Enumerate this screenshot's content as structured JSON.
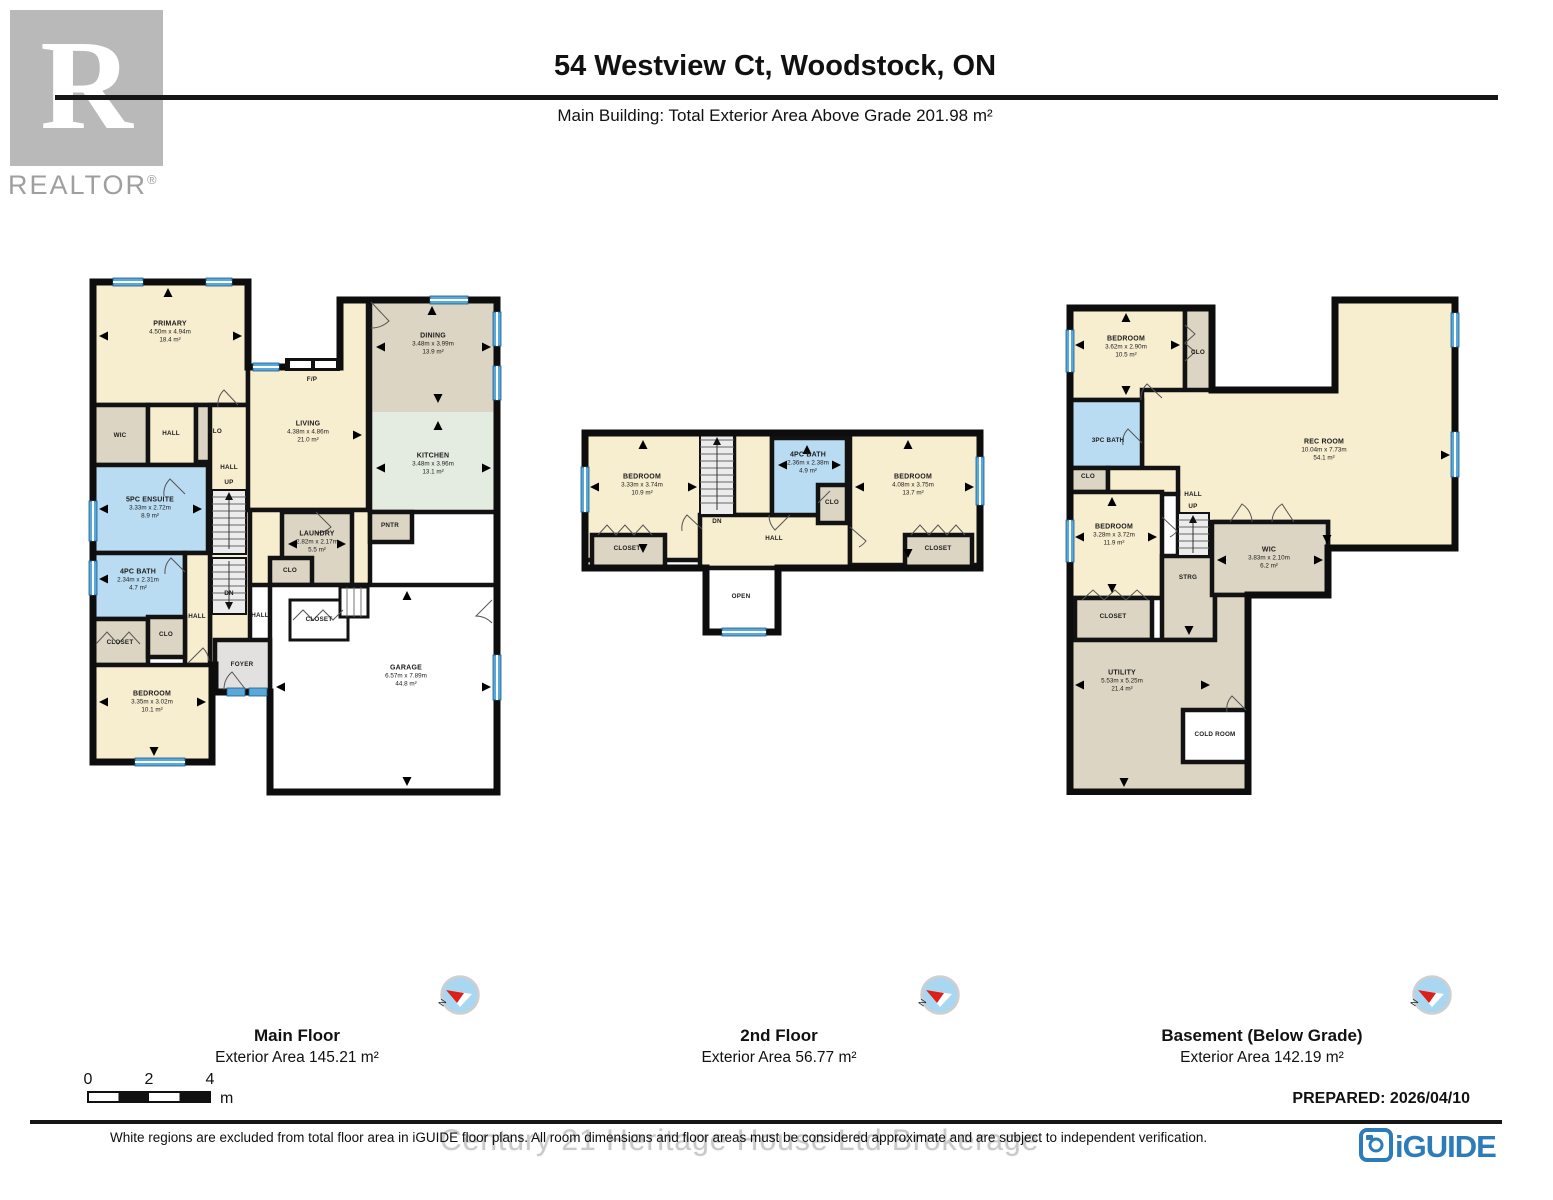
{
  "header": {
    "title": "54 Westview Ct, Woodstock, ON",
    "subtitle": "Main Building: Total Exterior Area Above Grade 201.98 m²",
    "realtor_letter": "R",
    "realtor_wordmark": "REALTOR",
    "realtor_reg": "®"
  },
  "plans": {
    "main": {
      "title": "Main Floor",
      "area": "Exterior Area 145.21 m²",
      "rooms": {
        "primary": {
          "name": "PRIMARY",
          "dims": "4.50m x 4.94m",
          "area": "18.4 m²"
        },
        "wic": {
          "name": "WIC"
        },
        "hall_upper": {
          "name": "HALL"
        },
        "clo_upper": {
          "name": "CLO"
        },
        "ensuite": {
          "name": "5PC ENSUITE",
          "dims": "3.33m x 2.72m",
          "area": "8.9 m²"
        },
        "bath": {
          "name": "4PC BATH",
          "dims": "2.34m x 2.31m",
          "area": "4.7 m²"
        },
        "clo_mid": {
          "name": "CLO"
        },
        "hall_center": {
          "name": "HALL"
        },
        "up": "UP",
        "dn": "DN",
        "hall_bed": {
          "name": "HALL"
        },
        "closet_bed": {
          "name": "CLOSET"
        },
        "bedroom": {
          "name": "BEDROOM",
          "dims": "3.35m x 3.02m",
          "area": "10.1 m²"
        },
        "living": {
          "name": "LIVING",
          "dims": "4.38m x 4.86m",
          "area": "21.0 m²"
        },
        "fp": {
          "name": "F/P"
        },
        "dining": {
          "name": "DINING",
          "dims": "3.48m x 3.99m",
          "area": "13.9 m²"
        },
        "kitchen": {
          "name": "KITCHEN",
          "dims": "3.48m x 3.96m",
          "area": "13.1 m²"
        },
        "pntr": {
          "name": "PNTR"
        },
        "laundry": {
          "name": "LAUNDRY",
          "dims": "2.82m x 2.17m",
          "area": "5.5 m²"
        },
        "clo_laundry": {
          "name": "CLO"
        },
        "hall_foyer": {
          "name": "HALL"
        },
        "foyer": {
          "name": "FOYER"
        },
        "closet_garage": {
          "name": "CLOSET"
        },
        "garage": {
          "name": "GARAGE",
          "dims": "6.57m x 7.89m",
          "area": "44.8 m²"
        }
      }
    },
    "second": {
      "title": "2nd Floor",
      "area": "Exterior Area 56.77 m²",
      "rooms": {
        "bedroom_left": {
          "name": "BEDROOM",
          "dims": "3.33m x 3.74m",
          "area": "10.9 m²"
        },
        "closet_left": {
          "name": "CLOSET"
        },
        "dn": "DN",
        "hall": {
          "name": "HALL"
        },
        "open": {
          "name": "OPEN"
        },
        "bath": {
          "name": "4PC BATH",
          "dims": "2.36m x 2.38m",
          "area": "4.9 m²"
        },
        "clo": {
          "name": "CLO"
        },
        "bedroom_right": {
          "name": "BEDROOM",
          "dims": "4.08m x 3.75m",
          "area": "13.7 m²"
        },
        "closet_right": {
          "name": "CLOSET"
        }
      }
    },
    "basement": {
      "title": "Basement (Below Grade)",
      "area": "Exterior Area 142.19 m²",
      "rooms": {
        "bedroom_top": {
          "name": "BEDROOM",
          "dims": "3.62m x 2.90m",
          "area": "10.5 m²"
        },
        "clo_top": {
          "name": "CLO"
        },
        "bath": {
          "name": "3PC BATH"
        },
        "clo_small": {
          "name": "CLO"
        },
        "rec": {
          "name": "REC ROOM",
          "dims": "10.04m x 7.73m",
          "area": "54.1 m²"
        },
        "hall": {
          "name": "HALL"
        },
        "up": "UP",
        "bedroom_mid": {
          "name": "BEDROOM",
          "dims": "3.28m x 3.72m",
          "area": "11.9 m²"
        },
        "closet": {
          "name": "CLOSET"
        },
        "strg": {
          "name": "STRG"
        },
        "wic": {
          "name": "WIC",
          "dims": "3.83m x 2.10m",
          "area": "6.2 m²"
        },
        "utility": {
          "name": "UTILITY",
          "dims": "5.53m x 5.25m",
          "area": "21.4 m²"
        },
        "cold": {
          "name": "COLD ROOM"
        }
      }
    }
  },
  "footer": {
    "scale": {
      "t0": "0",
      "t2": "2",
      "t4": "4",
      "unit": "m"
    },
    "compass_n": "N",
    "prepared": "PREPARED: 2026/04/10",
    "watermark": "Century 21 Heritage House Ltd Brokerage",
    "disclaimer": "White regions are excluded from total floor area in iGUIDE floor plans. All room dimensions and floor areas must be considered approximate and are subject to independent verification.",
    "iguide_label": "iGUIDE"
  }
}
